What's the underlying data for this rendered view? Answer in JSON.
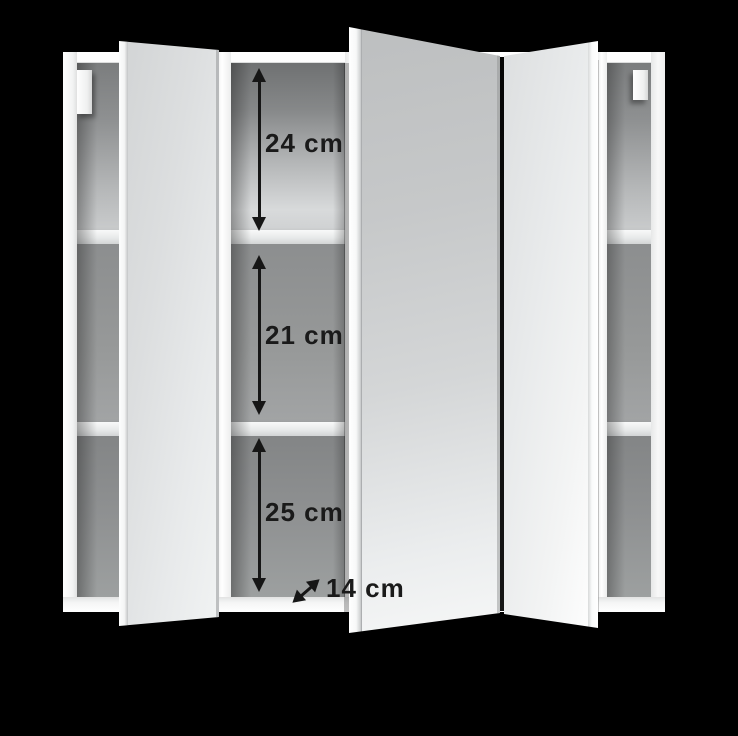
{
  "meta": {
    "description": "Product render of a white three-door mirrored bathroom wall cabinet shown open, with interior compartment dimension annotations on a black background"
  },
  "cabinet": {
    "type": "mirror-cabinet",
    "door_count": 3,
    "shelf_rows": 3
  },
  "annotations": {
    "unit": "cm",
    "items": [
      {
        "name": "top-compartment-height",
        "label": "24 cm",
        "value": 24,
        "orientation": "vertical"
      },
      {
        "name": "middle-compartment-height",
        "label": "21 cm",
        "value": 21,
        "orientation": "vertical"
      },
      {
        "name": "bottom-compartment-height",
        "label": "25 cm",
        "value": 25,
        "orientation": "vertical"
      },
      {
        "name": "compartment-depth",
        "label": "14 cm",
        "value": 14,
        "orientation": "diagonal"
      }
    ]
  },
  "colors": {
    "background": "#000000",
    "cabinet_white": "#f6f7f7",
    "interior_gray": "#9a9c9d",
    "mirror_light": "#d9dbdc",
    "annotation_ink": "#161616"
  }
}
